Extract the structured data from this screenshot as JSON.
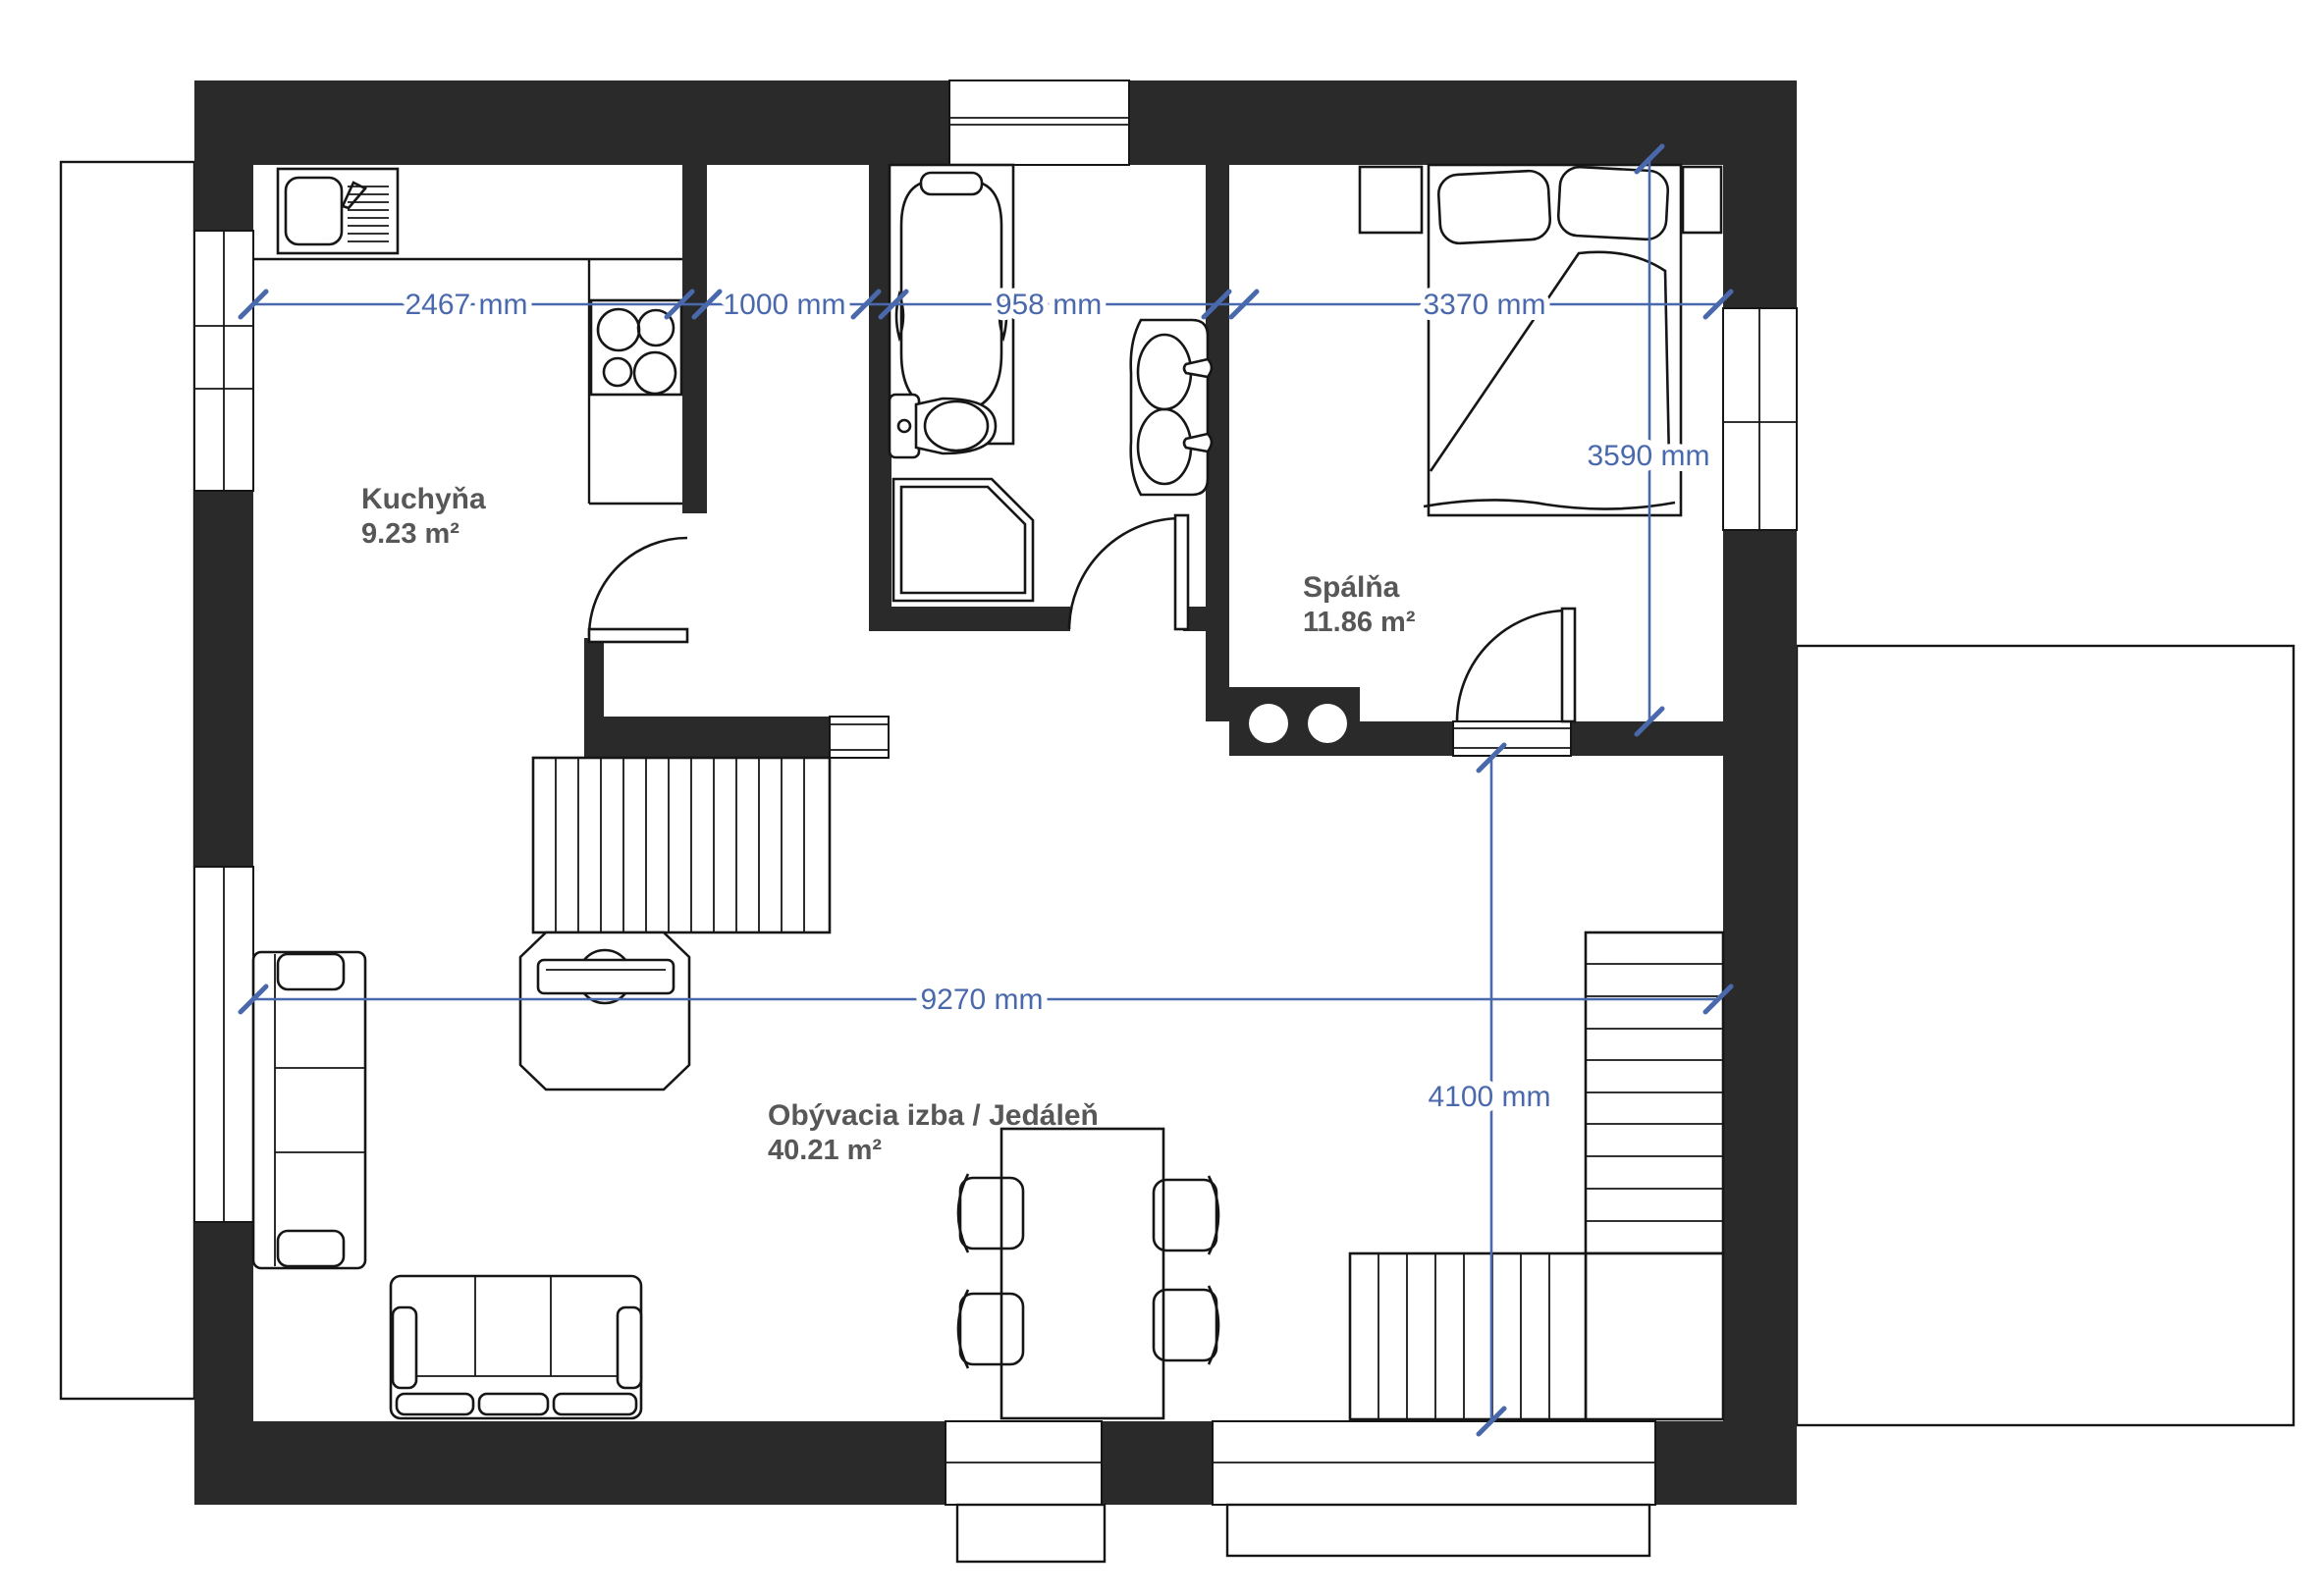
{
  "title": "Floor plan",
  "rooms": {
    "kitchen": {
      "name": "Kuchyňa",
      "area": "9.23 m²"
    },
    "bedroom": {
      "name": "Spálňa",
      "area": "11.86 m²"
    },
    "living": {
      "name": "Obývacia izba / Jedáleň",
      "area": "40.21 m²"
    }
  },
  "dimensions": {
    "kitchen_width": "2467 mm",
    "corridor_width": "1000 mm",
    "bathroom_width": "958 mm",
    "bedroom_width": "3370 mm",
    "bedroom_depth": "3590 mm",
    "living_width": "9270 mm",
    "living_depth": "4100 mm"
  },
  "colors": {
    "wall": "#2a2a2a",
    "dimension_blue": "#4a69ad",
    "label_gray": "#575757",
    "line_black": "#161616",
    "background": "#ffffff"
  }
}
